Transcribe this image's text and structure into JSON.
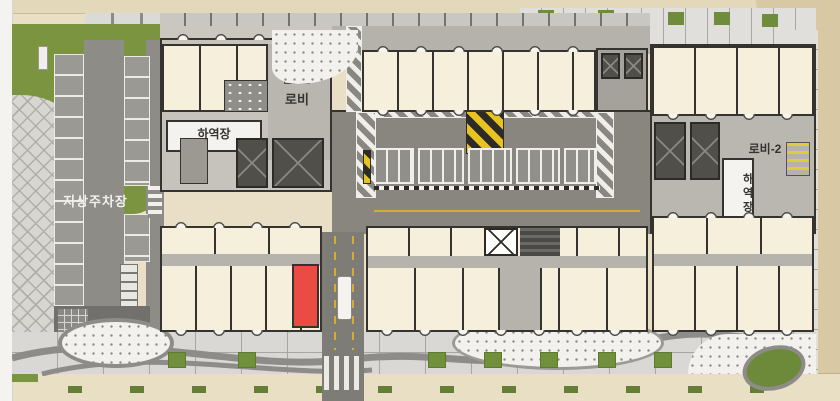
{
  "floor_plan": {
    "labels": {
      "ground_parking": "지상주차장",
      "lobby_1": "로비",
      "loading_dock_left": "하역장",
      "lobby_2": "로비-2",
      "loading_dock_right": "하역장"
    },
    "colors": {
      "unit_fill": "#f5efdc",
      "wall": "#35332f",
      "corridor": "#b6b3ac",
      "service_yard": "#89867f",
      "road": "#7e7c77",
      "lawn": "#7a9440",
      "sidewalk_beige": "#e8dfc6",
      "hazard_yellow": "#e7c320",
      "highlight_red": "#ec4b43"
    }
  }
}
